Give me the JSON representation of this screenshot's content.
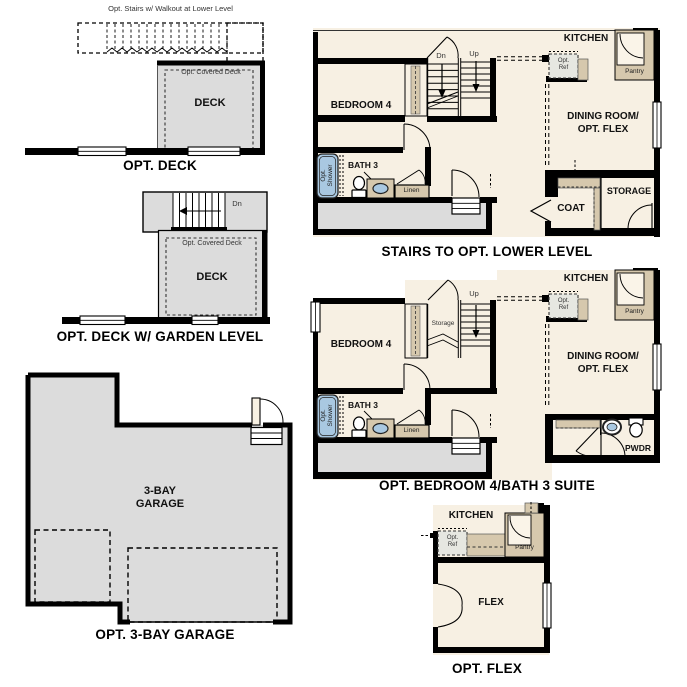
{
  "colors": {
    "wall": "#000000",
    "interior": "#f7f0e3",
    "deck": "#dcdcdc",
    "cabinetry": "#d6c8ad",
    "plumbing_blue": "#a9c8e1",
    "ref_box": "#e6e7e1"
  },
  "fig_opt_deck": {
    "title": "OPT. DECK",
    "stairs_note": "Opt. Stairs w/ Walkout at Lower Level",
    "covered_deck": "Opt. Covered Deck",
    "deck": "DECK"
  },
  "fig_deck_garden": {
    "title": "OPT. DECK W/ GARDEN LEVEL",
    "covered_deck": "Opt. Covered Deck",
    "deck": "DECK",
    "dn": "Dn"
  },
  "fig_garage": {
    "title": "OPT. 3-BAY GARAGE",
    "room": "3-BAY\nGARAGE"
  },
  "fig_stairs_lower": {
    "title": "STAIRS TO OPT. LOWER LEVEL",
    "bedroom": "BEDROOM 4",
    "bath": "BATH 3",
    "opt_shower": "Opt.\nShower",
    "linen": "Linen",
    "dn": "Dn",
    "up": "Up",
    "kitchen": "KITCHEN",
    "opt_ref": "Opt.\nRef",
    "pantry": "Pantry",
    "dining": "DINING ROOM/\nOPT. FLEX",
    "coat": "COAT",
    "storage": "STORAGE"
  },
  "fig_bed4_suite": {
    "title": "OPT. BEDROOM 4/BATH 3 SUITE",
    "bedroom": "BEDROOM 4",
    "bath": "BATH 3",
    "opt_shower": "Opt.\nShower",
    "linen": "Linen",
    "storage_closet": "Storage",
    "up": "Up",
    "kitchen": "KITCHEN",
    "opt_ref": "Opt.\nRef",
    "pantry": "Pantry",
    "dining": "DINING ROOM/\nOPT. FLEX",
    "pwdr": "PWDR"
  },
  "fig_opt_flex": {
    "title": "OPT. FLEX",
    "kitchen": "KITCHEN",
    "opt_ref": "Opt.\nRef",
    "pantry": "Pantry",
    "flex": "FLEX"
  }
}
